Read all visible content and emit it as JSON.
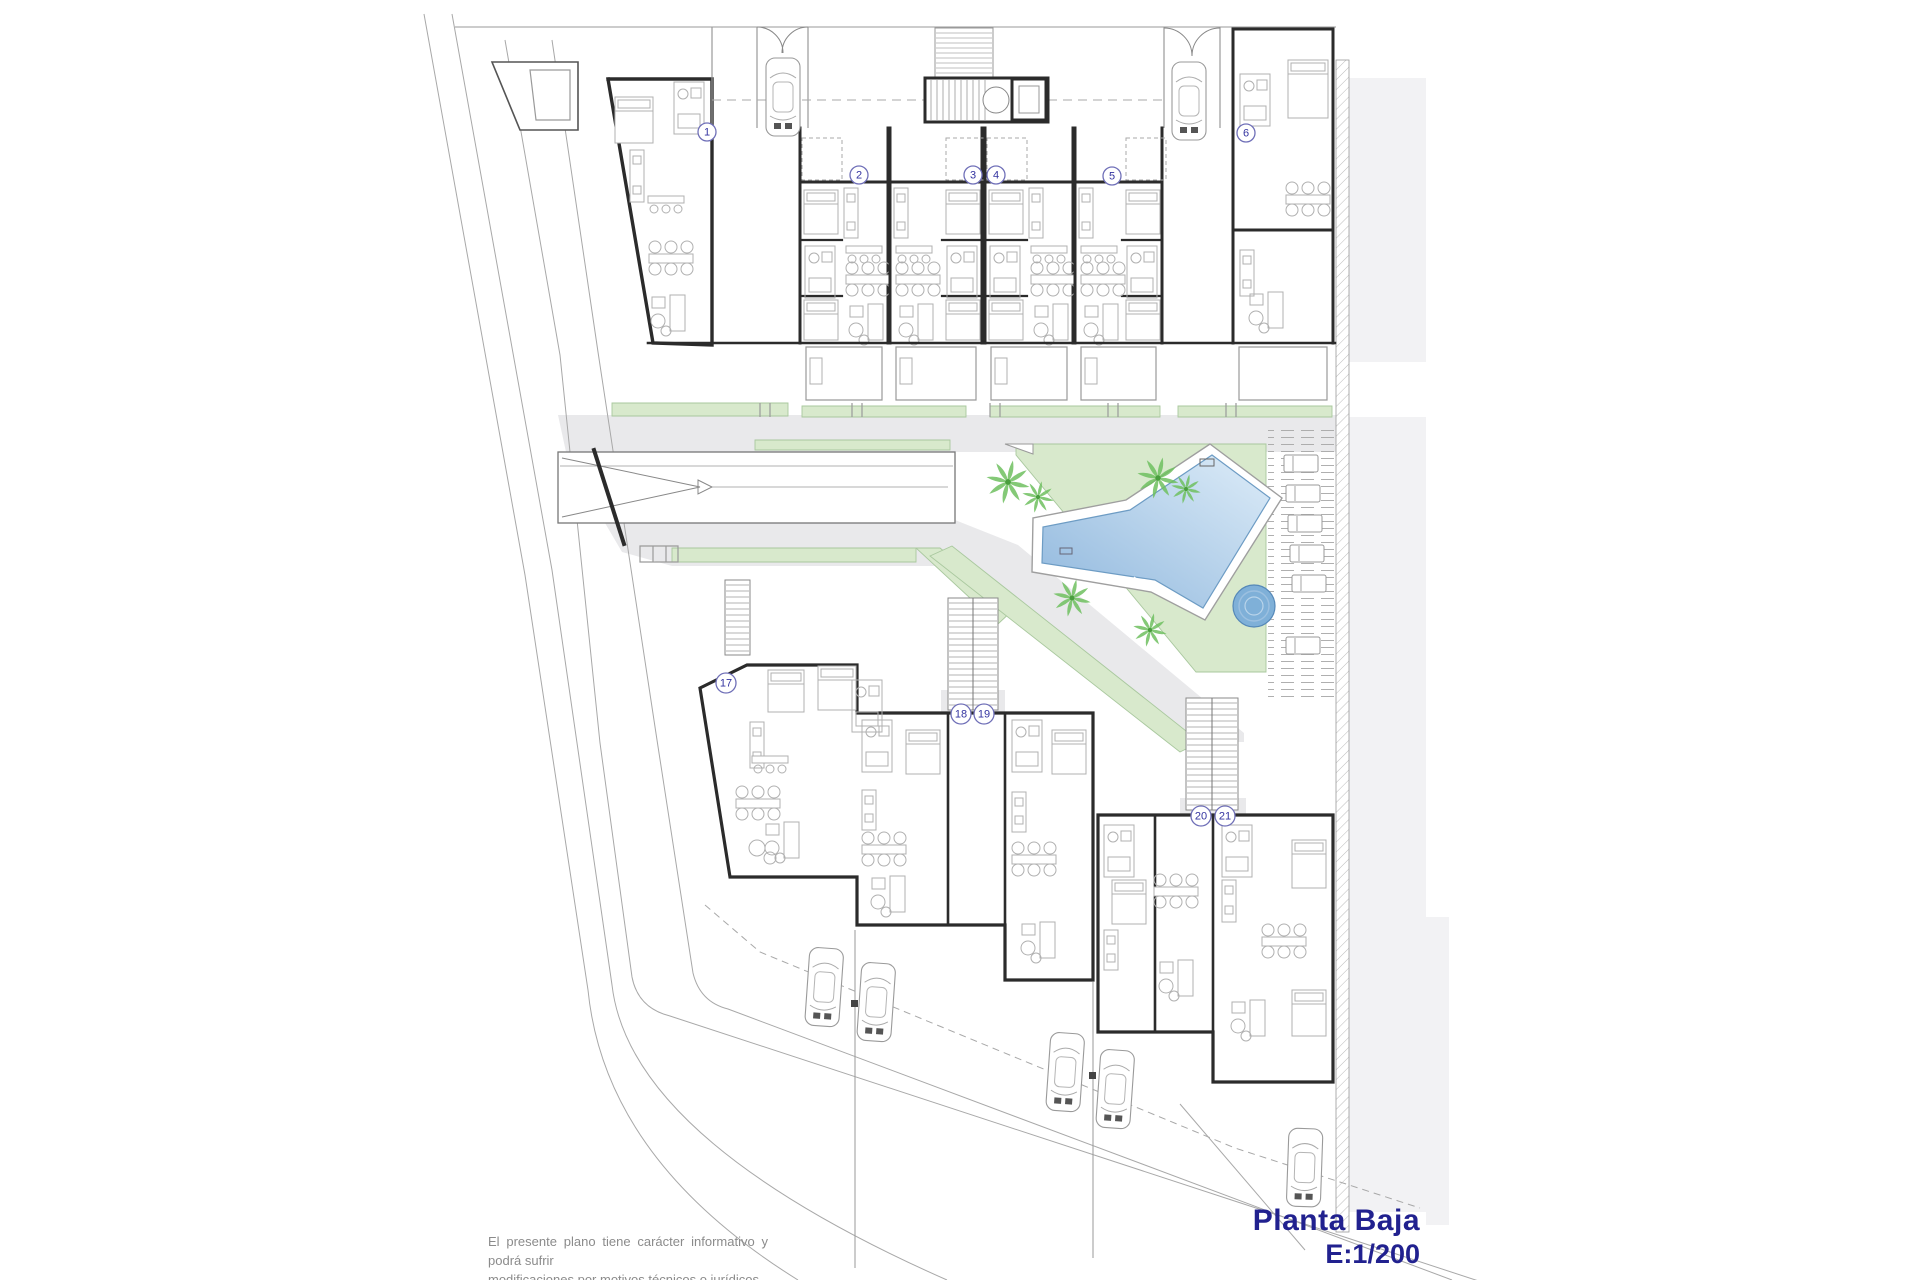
{
  "title": {
    "name": "Planta Baja",
    "scale": "E:1/200"
  },
  "disclaimer": {
    "line1": "El presente plano tiene carácter informativo y podrá sufrir",
    "line2": "modificaciones por motivos técnicos o jurídicos."
  },
  "colors": {
    "wall": "#2b2b2b",
    "light_wall": "#9a9a9a",
    "furniture": "#b0b0b0",
    "boundary": "#a8a8a8",
    "path_gray": "#e9e9eb",
    "side_gray": "#f2f2f4",
    "green": "#d8e9cc",
    "green_edge": "#a9c89e",
    "palm": "#6fbf5f",
    "palm_dark": "#4a9e3e",
    "pool_light": "#ddecf8",
    "pool_dark": "#8fb7dd",
    "pool_edge": "#6d9cc4",
    "jacuzzi": "#7fb0d8",
    "badge_ring": "#7070b8",
    "badge_text": "#3333a0",
    "navy": "#21218f",
    "note_gray": "#8b8b8b"
  },
  "unit_badges": [
    {
      "label": "1",
      "x": 707,
      "y": 132
    },
    {
      "label": "2",
      "x": 859,
      "y": 175
    },
    {
      "label": "3",
      "x": 973,
      "y": 175
    },
    {
      "label": "4",
      "x": 996,
      "y": 175
    },
    {
      "label": "5",
      "x": 1112,
      "y": 176
    },
    {
      "label": "6",
      "x": 1246,
      "y": 133
    },
    {
      "label": "17",
      "x": 726,
      "y": 683
    },
    {
      "label": "18",
      "x": 961,
      "y": 714
    },
    {
      "label": "19",
      "x": 984,
      "y": 714
    },
    {
      "label": "20",
      "x": 1201,
      "y": 816
    },
    {
      "label": "21",
      "x": 1225,
      "y": 816
    }
  ],
  "cars": [
    {
      "x": 766,
      "y": 58,
      "angle": 0
    },
    {
      "x": 1172,
      "y": 62,
      "angle": 0
    },
    {
      "x": 810,
      "y": 947,
      "angle": 4
    },
    {
      "x": 862,
      "y": 962,
      "angle": 4
    },
    {
      "x": 1051,
      "y": 1032,
      "angle": 4
    },
    {
      "x": 1101,
      "y": 1049,
      "angle": 4
    },
    {
      "x": 1289,
      "y": 1128,
      "angle": 2
    }
  ],
  "palm_trees": [
    {
      "x": 1008,
      "y": 482,
      "r": 22
    },
    {
      "x": 1038,
      "y": 497,
      "r": 16
    },
    {
      "x": 1158,
      "y": 478,
      "r": 21
    },
    {
      "x": 1186,
      "y": 489,
      "r": 15
    },
    {
      "x": 1072,
      "y": 598,
      "r": 19
    },
    {
      "x": 1150,
      "y": 630,
      "r": 17
    }
  ],
  "sun_loungers": [
    {
      "x": 1284,
      "y": 455
    },
    {
      "x": 1286,
      "y": 485
    },
    {
      "x": 1288,
      "y": 515
    },
    {
      "x": 1290,
      "y": 545
    },
    {
      "x": 1292,
      "y": 575
    },
    {
      "x": 1286,
      "y": 637
    }
  ]
}
